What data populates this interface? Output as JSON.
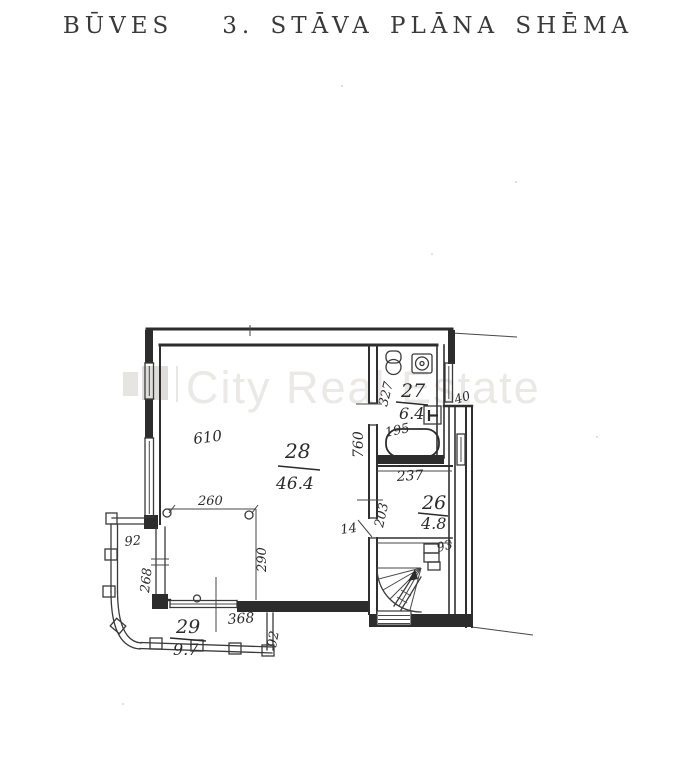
{
  "title": "BŪVES   3. STĀVA PLĀNA SHĒMA",
  "watermark": {
    "text": "City Real Estate",
    "color": "#ebe9e6"
  },
  "plan": {
    "rooms": {
      "room28": {
        "number": "28",
        "area": "46.4"
      },
      "room27": {
        "number": "27",
        "area": "6.4"
      },
      "room26": {
        "number": "26",
        "area": "4.8"
      },
      "room29": {
        "number": "29",
        "area": "9.7"
      }
    },
    "dims": {
      "d610": "610",
      "d260": "260",
      "d290": "290",
      "d268": "268",
      "d92a": "92",
      "d368": "368",
      "d92b": "92",
      "d327": "327",
      "d760": "760",
      "d195": "195",
      "d40": "40",
      "d237": "237",
      "d203": "203",
      "d14": "14",
      "d93": "93"
    }
  },
  "colors": {
    "ink": "#2c2c2c",
    "paper": "#ffffff"
  }
}
